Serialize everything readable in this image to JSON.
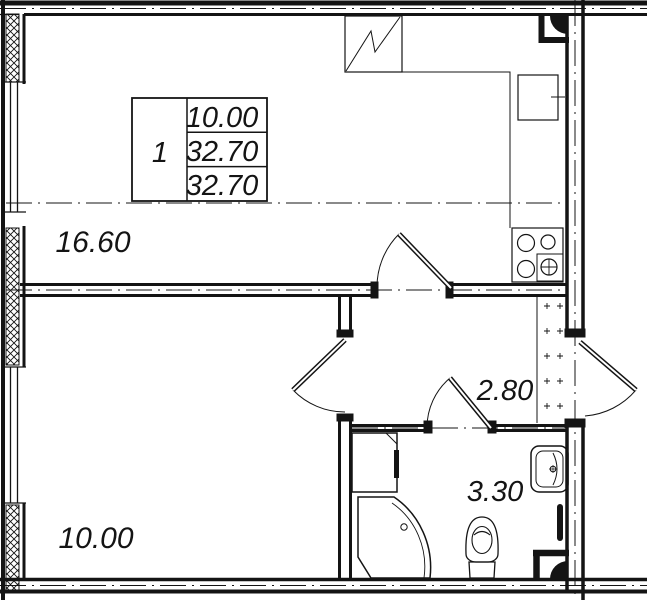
{
  "colors": {
    "line": "#141414",
    "background": "#ffffff"
  },
  "stamp": {
    "room_count": "1",
    "living_area": "10.00",
    "area": "32.70",
    "total_area": "32.70"
  },
  "rooms": {
    "living_kitchen": {
      "area": "16.60"
    },
    "bedroom": {
      "area": "10.00"
    },
    "hallway": {
      "area": "2.80"
    },
    "bathroom": {
      "area": "3.30"
    }
  }
}
